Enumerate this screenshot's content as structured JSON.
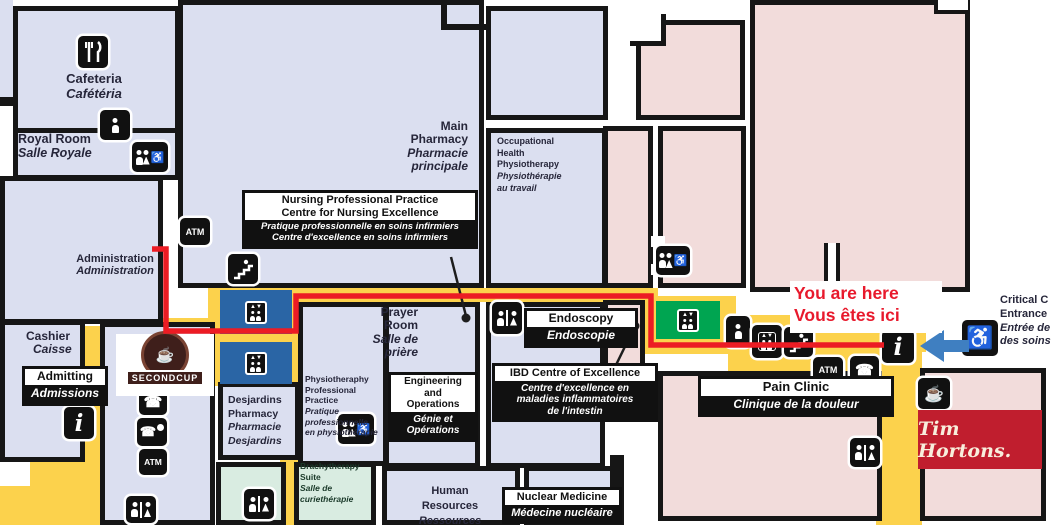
{
  "title": "Hospital floor map with route to Critical Care Entrance",
  "colors": {
    "room_blue": "#dbdff0",
    "room_pink": "#f2dcdb",
    "room_mint": "#d9ece1",
    "corridor_yellow": "#fcd24c",
    "wall": "#161616",
    "route_red": "#ec1c24",
    "elevator_blue": "#2a65a5",
    "elevator_green": "#00a551",
    "arrow_blue": "#3f7fc1",
    "tim_red": "#c01e2e",
    "second_cup_brown": "#3f1f1b",
    "you_are_here_red": "#e8192c"
  },
  "icons": {
    "atm": "ATM",
    "info": "i",
    "phone": "☎",
    "coffee": "☕",
    "wheelchair": "♿",
    "elevator_arrows": "▲▼"
  },
  "labels": {
    "cafeteria": {
      "en": "Cafeteria",
      "fr": "Cafétéria"
    },
    "royal_room": {
      "en": "Royal Room",
      "fr": "Salle Royale"
    },
    "main_pharmacy": {
      "en1": "Main",
      "en2": "Pharmacy",
      "fr1": "Pharmacie",
      "fr2": "principale"
    },
    "occupational": {
      "en1": "Occupational",
      "en2": "Health",
      "en3": "Physiotherapy",
      "fr1": "Physiothérapie",
      "fr2": "au travail"
    },
    "nursing": {
      "en1": "Nursing Professional Practice",
      "en2": "Centre for Nursing Excellence",
      "fr1": "Pratique professionnelle en soins infirmiers",
      "fr2": "Centre d'excellence en soins infirmiers"
    },
    "administration": {
      "en": "Administration",
      "fr": "Administration"
    },
    "cashier": {
      "en": "Cashier",
      "fr": "Caisse"
    },
    "admitting": {
      "en": "Admitting",
      "fr": "Admissions"
    },
    "second_cup": "SECONDCUP",
    "desjardins": {
      "en1": "Desjardins",
      "en2": "Pharmacy",
      "fr1": "Pharmacie",
      "fr2": "Desjardins"
    },
    "prayer": {
      "en1": "Prayer",
      "en2": "Room",
      "fr1": "Salle de",
      "fr2": "prière"
    },
    "physio": {
      "en1": "Physiotheraphy",
      "en2": "Professional",
      "en3": "Practice",
      "fr1": "Pratique",
      "fr2": "professionnelle",
      "fr3": "en physiothérapie"
    },
    "engineering": {
      "en1": "Engineering and",
      "en2": "Operations",
      "fr1": "Génie et",
      "fr2": "Opérations"
    },
    "endoscopy": {
      "en": "Endoscopy",
      "fr": "Endoscopie"
    },
    "ibd": {
      "en": "IBD Centre of Excellence",
      "fr1": "Centre d'excellence en",
      "fr2": "maladies inflammatoires",
      "fr3": "de l'intestin"
    },
    "brachytherapy": {
      "en1": "Brachytherapy",
      "en2": "Suite",
      "fr1": "Salle de",
      "fr2": "curiethérapie"
    },
    "human_resources": {
      "en1": "Human",
      "en2": "Resources",
      "fr1": "Ressources"
    },
    "nuclear": {
      "en": "Nuclear Medicine",
      "fr": "Médecine nucléaire"
    },
    "pain_clinic": {
      "en": "Pain Clinic",
      "fr": "Clinique de la douleur"
    },
    "critical_care": {
      "en1": "Critical C",
      "en2": "Entrance",
      "fr1": "Entrée de",
      "fr2": "des soins"
    },
    "you_are_here": {
      "en": "You are here",
      "fr": "Vous êtes ici"
    },
    "tim_hortons": "Tim Hortons."
  },
  "route": {
    "color": "#ec1c24",
    "points": "152,249 166,249 166,331 296,331 296,296 651,296 651,345 884,345"
  }
}
